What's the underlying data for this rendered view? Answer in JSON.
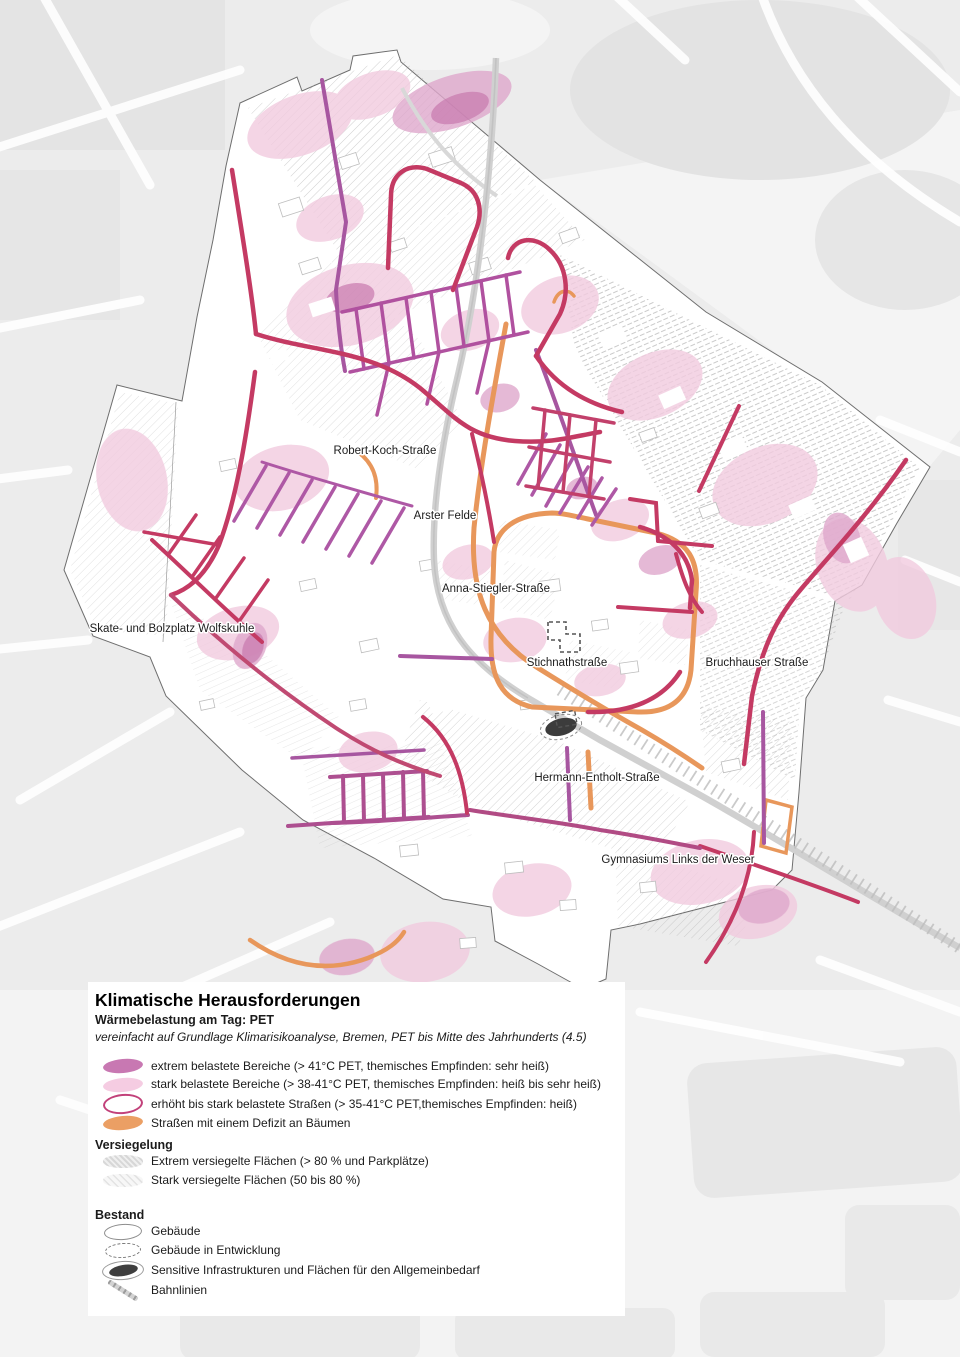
{
  "map": {
    "labels": [
      {
        "id": "robert-koch-strasse",
        "text": "Robert-Koch-Straße"
      },
      {
        "id": "arster-felde",
        "text": "Arster Felde"
      },
      {
        "id": "anna-stiegler-strasse",
        "text": "Anna-Stiegler-Straße"
      },
      {
        "id": "skate-und-bolzplatz-wolfskuhle",
        "text": "Skate- und Bolzplatz Wolfskuhle"
      },
      {
        "id": "stichnathstrasse",
        "text": "Stichnathstraße"
      },
      {
        "id": "bruchhauser-strasse",
        "text": "Bruchhauser Straße"
      },
      {
        "id": "hermann-entholt-strasse",
        "text": "Hermann-Entholt-Straße"
      },
      {
        "id": "gymnasiums-links-der-weser",
        "text": "Gymnasiums Links der Weser"
      }
    ]
  },
  "legend": {
    "title": "Klimatische Herausforderungen",
    "subtitle": "Wärmebelastung am Tag: PET",
    "source_note": "vereinfacht auf Grundlage Klimarisikoanalyse, Bremen, PET bis Mitte des Jahrhunderts (4.5)",
    "heat_items": [
      {
        "label": "extrem belastete Bereiche (> 41°C PET, themisches Empfinden: sehr heiß)",
        "color": "#c878b2"
      },
      {
        "label": "stark belastete Bereiche (> 38-41°C PET, themisches Empfinden: heiß bis sehr heiß)",
        "color": "#f5cce2"
      },
      {
        "label": "erhöht bis stark belastete Straßen (> 35-41°C PET,themisches Empfinden: heiß)",
        "color": "#c2417a"
      },
      {
        "label": "Straßen mit einem Defizit an Bäumen",
        "color": "#eb9f64"
      }
    ],
    "sealing": {
      "heading": "Versiegelung",
      "items": [
        {
          "label": "Extrem versiegelte Flächen (> 80 % und Parkplätze)"
        },
        {
          "label": "Stark versiegelte Flächen (50 bis 80 %)"
        }
      ]
    },
    "stock": {
      "heading": "Bestand",
      "items": [
        {
          "label": "Gebäude"
        },
        {
          "label": "Gebäude in Entwicklung"
        },
        {
          "label": "Sensitive Infrastrukturen und Flächen für den Allgemeinbedarf"
        },
        {
          "label": "Bahnlinien"
        }
      ]
    }
  },
  "colors": {
    "extreme_heat_area": "#c878b2",
    "strong_heat_area": "#f5cce2",
    "street_heat_outline": "#c2417a",
    "tree_deficit_street": "#eb9f64",
    "street_crimson": "#c43a63",
    "street_purple": "#a756a0",
    "railway": "#cfcfcf",
    "map_background": "#ececec"
  }
}
